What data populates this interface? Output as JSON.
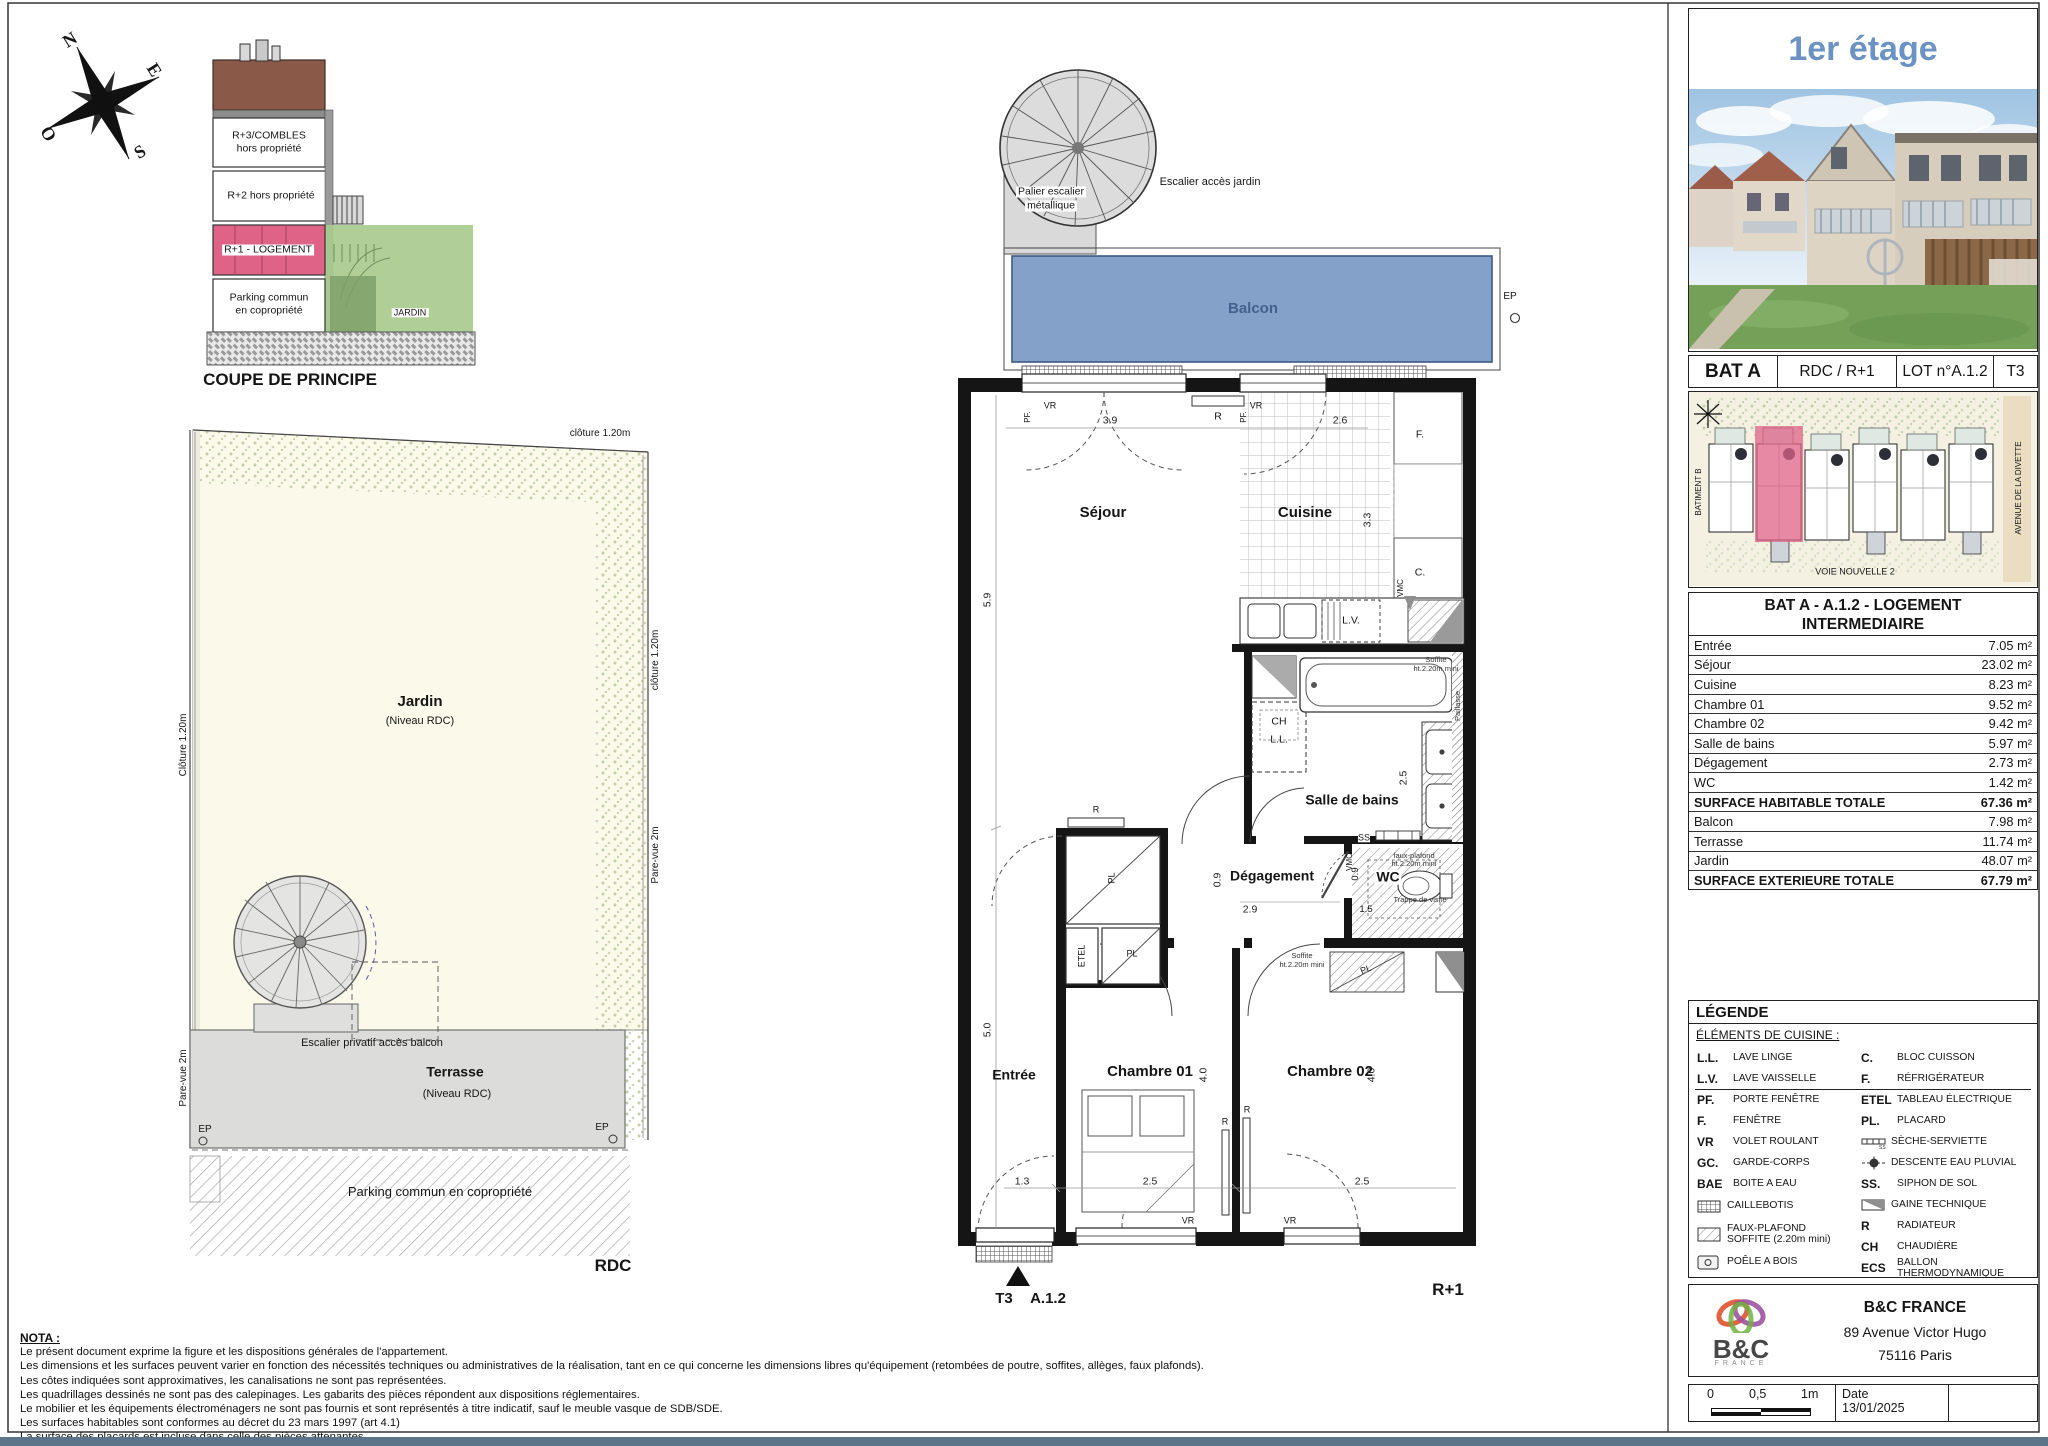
{
  "colors": {
    "accent_blue": "#6b92c3",
    "balcony_fill": "#7e9dc8",
    "unit_pink": "#df6287",
    "garden_green": "#a9cb8e",
    "bottom_bar": "#5d7488"
  },
  "compass": {
    "north": "N",
    "east": "E",
    "south": "S",
    "west": "O"
  },
  "coupe": {
    "caption": "COUPE DE PRINCIPE",
    "r3a": "R+3/COMBLES",
    "r3b": "hors propriété",
    "r2": "R+2 hors propriété",
    "r1": "R+1 - LOGEMENT",
    "pk1": "Parking commun",
    "pk2": "en copropriété",
    "jardin": "JARDIN"
  },
  "garden": {
    "fence_top": "clôture 1.20m",
    "fence_left": "Clôture 1.20m",
    "fence_right": "clôture 1.20m",
    "pare_vue_right": "Pare-vue 2m",
    "pare_vue_left": "Pare-vue 2m",
    "jardin": "Jardin",
    "jardin_sub": "(Niveau RDC)",
    "escalier": "Escalier privatif accès balcon",
    "terrasse": "Terrasse",
    "terrasse_sub": "(Niveau RDC)",
    "ep": "EP",
    "parking": "Parking commun en copropriété",
    "level": "RDC"
  },
  "plan": {
    "palier1": "Palier escalier",
    "palier2": "métallique",
    "esc_jardin": "Escalier accès jardin",
    "balcon": "Balcon",
    "ep": "EP",
    "sejour": "Séjour",
    "cuisine": "Cuisine",
    "sdb": "Salle de bains",
    "degagement": "Dégagement",
    "wc": "WC",
    "entree": "Entrée",
    "ch1": "Chambre 01",
    "ch2": "Chambre 02",
    "level": "R+1",
    "marker_type": "T3",
    "marker_lot": "A.1.2",
    "dims": {
      "w_sejour": "3.9",
      "w_cuisine": "2.6",
      "h_sejour": "5.9",
      "h_cuisine": "3.3",
      "h_entree": "5.0",
      "h_sdb": "2.5",
      "h_deg": "0.9",
      "w_deg": "2.9",
      "h_wc": "0.9",
      "w_wc": "1.5",
      "w_entree": "1.3",
      "w_ch1": "2.5",
      "w_ch2": "2.5",
      "h_ch1": "4.0",
      "h_ch2": "4.0"
    },
    "tags": {
      "vr": "VR",
      "pf": "PF.",
      "r": "R",
      "f": "F.",
      "c": "C.",
      "lv": "L.V.",
      "ch": "CH",
      "ll": "L.L.",
      "etel": "ETEL",
      "pl": "PL",
      "ss": "SS",
      "vmc": "VMC"
    },
    "notes": {
      "soffite1": "Soffite",
      "soffite2": "ht.2.20m mini",
      "fp1": "faux-plafond",
      "fp2": "ht.2.20m mini",
      "trappe": "Trappe de visite",
      "paillasse": "Paillasse"
    }
  },
  "sidebar": {
    "title": "1er étage",
    "bat_row": {
      "bat": "BAT A",
      "levels": "RDC / R+1",
      "lot": "LOT n°A.1.2",
      "type": "T3"
    },
    "site": {
      "batiment_b": "BATIMENT B",
      "avenue": "AVENUE DE LA DIVETTE",
      "voie": "VOIE NOUVELLE 2"
    },
    "surface_table": {
      "title1": "BAT A - A.1.2 - LOGEMENT",
      "title2": "INTERMEDIAIRE",
      "rows": [
        {
          "label": "Entrée",
          "value": "7.05 m²"
        },
        {
          "label": "Séjour",
          "value": "23.02 m²"
        },
        {
          "label": "Cuisine",
          "value": "8.23 m²"
        },
        {
          "label": "Chambre 01",
          "value": "9.52 m²"
        },
        {
          "label": "Chambre 02",
          "value": "9.42 m²"
        },
        {
          "label": "Salle de bains",
          "value": "5.97 m²"
        },
        {
          "label": "Dégagement",
          "value": "2.73 m²"
        },
        {
          "label": "WC",
          "value": "1.42 m²"
        },
        {
          "label": "SURFACE HABITABLE TOTALE",
          "value": "67.36 m²"
        },
        {
          "label": "Balcon",
          "value": "7.98 m²"
        },
        {
          "label": "Terrasse",
          "value": "11.74 m²"
        },
        {
          "label": "Jardin",
          "value": "48.07 m²"
        },
        {
          "label": "SURFACE EXTERIEURE TOTALE",
          "value": "67.79 m²"
        }
      ]
    },
    "legend": {
      "title": "LÉGENDE",
      "kitchen_header": "ÉLÉMENTS DE CUISINE :",
      "left": [
        {
          "abbr": "L.L.",
          "label": "LAVE LINGE"
        },
        {
          "abbr": "L.V.",
          "label": "LAVE VAISSELLE"
        },
        {
          "abbr": "PF.",
          "label": "PORTE FENÊTRE"
        },
        {
          "abbr": "F.",
          "label": "FENÊTRE"
        },
        {
          "abbr": "VR",
          "label": "VOLET ROULANT"
        },
        {
          "abbr": "GC.",
          "label": "GARDE-CORPS"
        },
        {
          "abbr": "BAE",
          "label": "BOITE A EAU"
        },
        {
          "abbr": "",
          "label": "CAILLEBOTIS"
        },
        {
          "abbr": "",
          "label": "FAUX-PLAFOND SOFFITE (2.20m mini)"
        },
        {
          "abbr": "",
          "label": "POÊLE A BOIS"
        }
      ],
      "right": [
        {
          "abbr": "C.",
          "label": "BLOC CUISSON"
        },
        {
          "abbr": "F.",
          "label": "RÉFRIGÉRATEUR"
        },
        {
          "abbr": "ETEL",
          "label": "TABLEAU ÉLECTRIQUE"
        },
        {
          "abbr": "PL.",
          "label": "PLACARD"
        },
        {
          "abbr": "",
          "label": "SÈCHE-SERVIETTE"
        },
        {
          "abbr": "",
          "label": "DESCENTE EAU PLUVIAL"
        },
        {
          "abbr": "SS.",
          "label": "SIPHON DE SOL"
        },
        {
          "abbr": "",
          "label": "GAINE TECHNIQUE"
        },
        {
          "abbr": "R",
          "label": "RADIATEUR"
        },
        {
          "abbr": "CH",
          "label": "CHAUDIÈRE"
        },
        {
          "abbr": "ECS",
          "label": "BALLON THERMODYNAMIQUE"
        }
      ]
    },
    "company": {
      "name": "B&C FRANCE",
      "address1": "89 Avenue Victor Hugo",
      "address2": "75116 Paris",
      "logo_text": "B&C",
      "logo_sub": "FRANCE"
    },
    "scale": {
      "t0": "0",
      "t05": "0,5",
      "t1": "1m"
    },
    "date_label": "Date",
    "date_value": "13/01/2025"
  },
  "nota": {
    "title": "NOTA :",
    "lines": [
      "Le présent document exprime la figure et les dispositions générales de l'appartement.",
      "Les dimensions et les surfaces peuvent varier en fonction des nécessités techniques ou administratives de la réalisation, tant en ce qui concerne les dimensions libres qu'équipement (retombées de poutre, soffites, allèges, faux plafonds).",
      "Les côtes indiquées sont approximatives, les canalisations ne sont pas représentées.",
      "Les quadrillages dessinés ne sont pas des calepinages. Les gabarits des pièces répondent aux dispositions réglementaires.",
      "Le mobilier et les équipements électroménagers ne sont pas fournis et sont représentés à titre indicatif, sauf le meuble vasque de SDB/SDE.",
      "Les surfaces habitables sont conformes au décret du 23 mars 1997 (art 4.1)",
      "La surface des placards est incluse dans celle des pièces attenantes."
    ]
  }
}
